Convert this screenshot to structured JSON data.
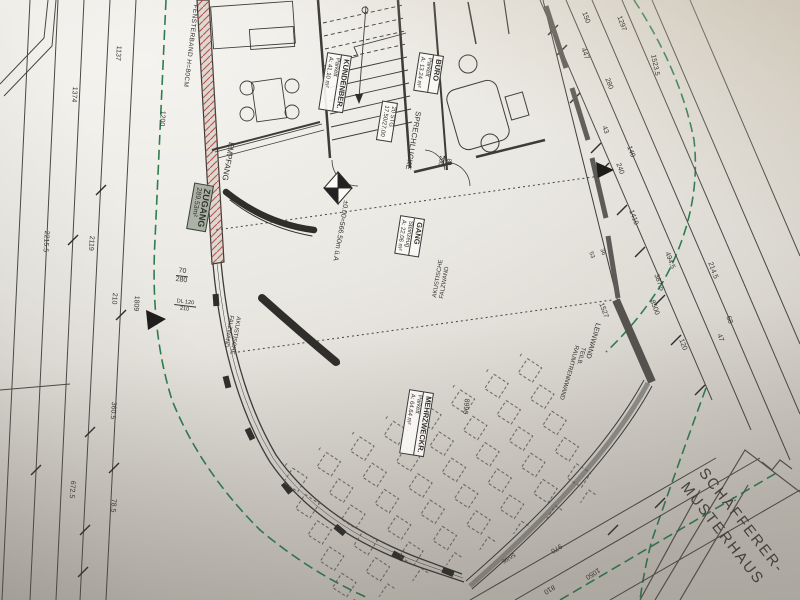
{
  "colors": {
    "boundary_green": "#2e7d4f",
    "wall_hatch_red": "#b0453c",
    "paper": "#e9e7e2",
    "ink": "#3c3a36",
    "zugang_box": "#a8b0a2"
  },
  "rooms": {
    "zugang": {
      "name": "ZUGANG",
      "area": "289.53m²"
    },
    "kundenber": {
      "name": "KUNDENBER.",
      "floor": "Parkett",
      "area": "A: 41.10 m²"
    },
    "buero": {
      "name": "BÜRO",
      "floor": "Parkett",
      "area": "A: 13.24 m²"
    },
    "gang": {
      "name": "GANG",
      "floor": "Steinzeug",
      "area": "A: 22.06 m²"
    },
    "mehrzweckr": {
      "name": "MEHRZWECKR.",
      "floor": "Parkett",
      "area": "A: 64.64 m²"
    }
  },
  "annotations": {
    "fensterband": "FENSTERBAND H=80CM",
    "empfang": "EMPFANG",
    "sprechlucke": "SPRECHLUCKE",
    "stairs_line1": "20 STG",
    "stairs_line2": "17.50/27.00",
    "level": "±0.00=566.50m ü.A",
    "akustische_line1": "AKUSTISCHE",
    "akustische_line2": "FALZWAND",
    "leinwand": "LEINWAND",
    "raumtrenn_line1": "TEILB.",
    "raumtrenn_line2": "RAUMTRENNWAND",
    "door_sprech_top": "80",
    "door_sprech_bottom": "200",
    "door_zugang_top": "70",
    "door_zugang_bottom": "280",
    "door_dl_line1": "DL 120",
    "door_dl_line2": "210",
    "window_bottom": "56/95"
  },
  "title": {
    "line1": "SCHÄFFERER-",
    "line2": "MUSTERHAUS"
  },
  "dimensions": {
    "left": [
      "1137",
      "1374",
      "1200",
      "2215.5",
      "2119",
      "210",
      "1809",
      "360.5",
      "672.5",
      "78.5"
    ],
    "right": [
      "150",
      "1297",
      "447",
      "280",
      "1523.5",
      "43",
      "140",
      "240",
      "1410",
      "53",
      "36",
      "1527",
      "8500",
      "494.5",
      "387.5",
      "214.5",
      "68",
      "47",
      "120"
    ],
    "bottom": [
      "8990",
      "970",
      "810",
      "1050"
    ]
  }
}
